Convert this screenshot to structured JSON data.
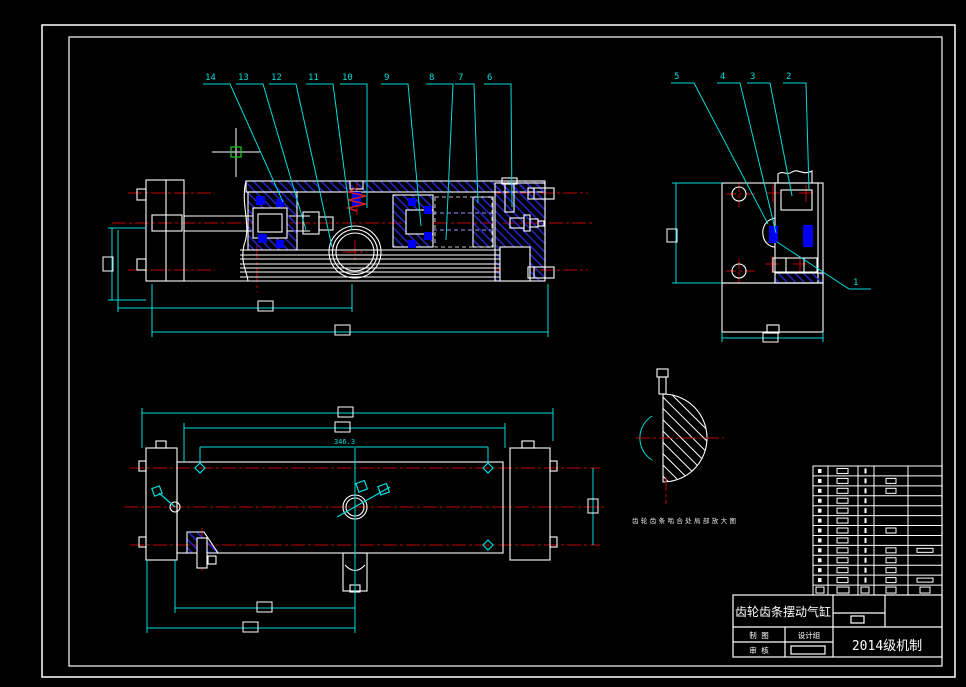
{
  "drawing": {
    "title": "齿轮齿条摆动气缸",
    "course_label": "2014级机制",
    "title_block": {
      "row1_left": "制 图",
      "row1_right": "设计组",
      "row2_left": "审 核"
    },
    "callouts": {
      "c1": "1",
      "c2": "2",
      "c3": "3",
      "c4": "4",
      "c5": "5",
      "c6": "6",
      "c7": "7",
      "c8": "8",
      "c9": "9",
      "c10": "10",
      "c11": "11",
      "c12": "12",
      "c13": "13",
      "c14": "14"
    },
    "dimensions": {
      "length_mid": "346.3"
    },
    "detail_note": "齿轮齿条啮合处局部放大图",
    "colors": {
      "outline": "#ffffff",
      "dimension": "#00dcdc",
      "centerline": "#c00000",
      "hatch_blue": "#2828d8",
      "seal_blue": "#0000ee",
      "cursor_pickbox": "#22cc22",
      "background": "#000000"
    },
    "bom": {
      "rows": 13,
      "left": 813,
      "right": 942,
      "top": 466,
      "bottom": 595,
      "col_x": [
        813,
        828,
        858,
        874,
        908,
        942
      ],
      "rows_with_col4": [
        2,
        3,
        7,
        9,
        10,
        11,
        12
      ],
      "rows_with_col5": [
        9,
        12
      ],
      "header_row": 13
    }
  }
}
